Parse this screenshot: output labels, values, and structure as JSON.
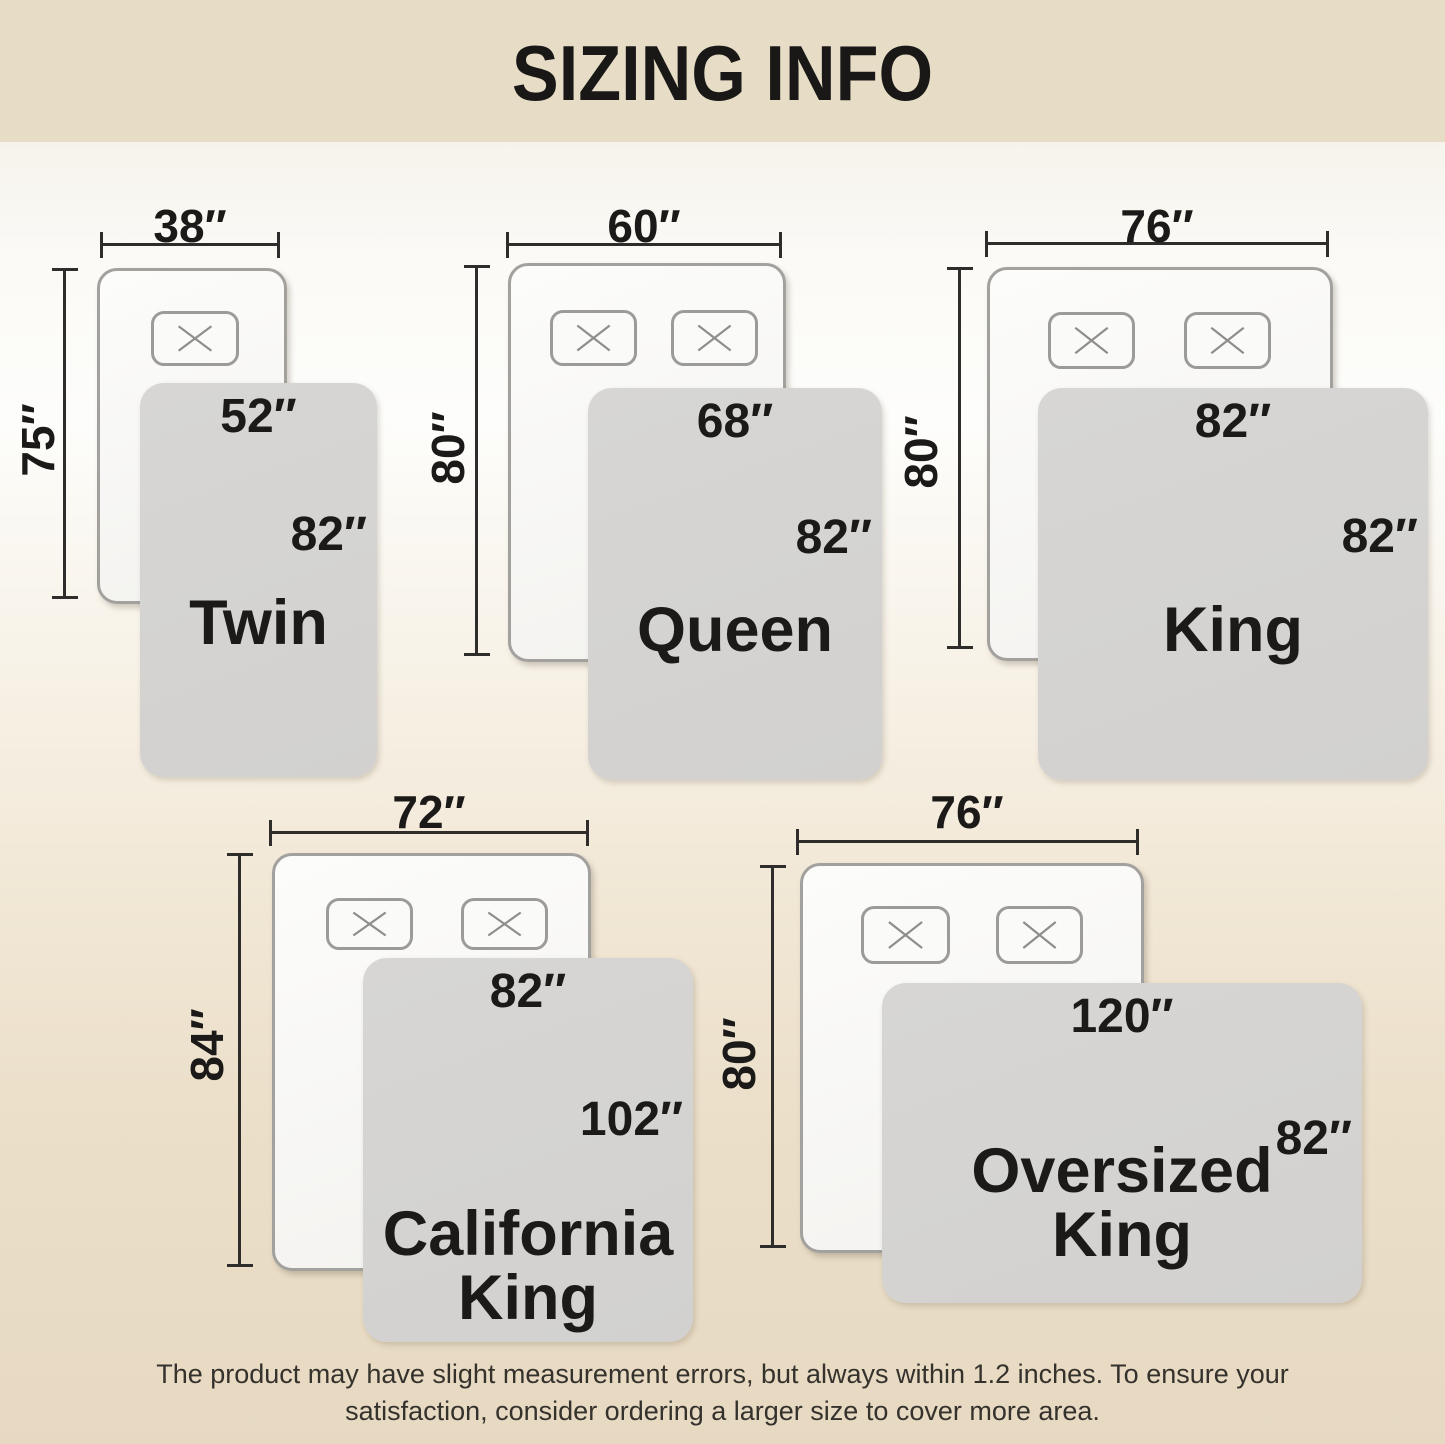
{
  "header": {
    "title": "SIZING INFO"
  },
  "colors": {
    "header-bg": "#e7ddc6",
    "blanket": "#d4d3d1",
    "line": "#2e2d2b",
    "text": "#1b1a18"
  },
  "beds": [
    {
      "name_lines": [
        "Twin"
      ],
      "mattress_width": "38″",
      "mattress_length": "75″",
      "blanket_width": "52″",
      "blanket_length": "82″",
      "pillows": 1
    },
    {
      "name_lines": [
        "Queen"
      ],
      "mattress_width": "60″",
      "mattress_length": "80″",
      "blanket_width": "68″",
      "blanket_length": "82″",
      "pillows": 2
    },
    {
      "name_lines": [
        "King"
      ],
      "mattress_width": "76″",
      "mattress_length": "80″",
      "blanket_width": "82″",
      "blanket_length": "82″",
      "pillows": 2
    },
    {
      "name_lines": [
        "California",
        "King"
      ],
      "mattress_width": "72″",
      "mattress_length": "84″",
      "blanket_width": "82″",
      "blanket_length": "102″",
      "pillows": 2
    },
    {
      "name_lines": [
        "Oversized",
        "King"
      ],
      "mattress_width": "76″",
      "mattress_length": "80″",
      "blanket_width": "120″",
      "blanket_length": "82″",
      "pillows": 2
    }
  ],
  "footer": {
    "line1": "The product may have slight measurement errors, but always within 1.2 inches. To ensure your",
    "line2": "satisfaction, consider ordering a larger size to cover more area."
  }
}
